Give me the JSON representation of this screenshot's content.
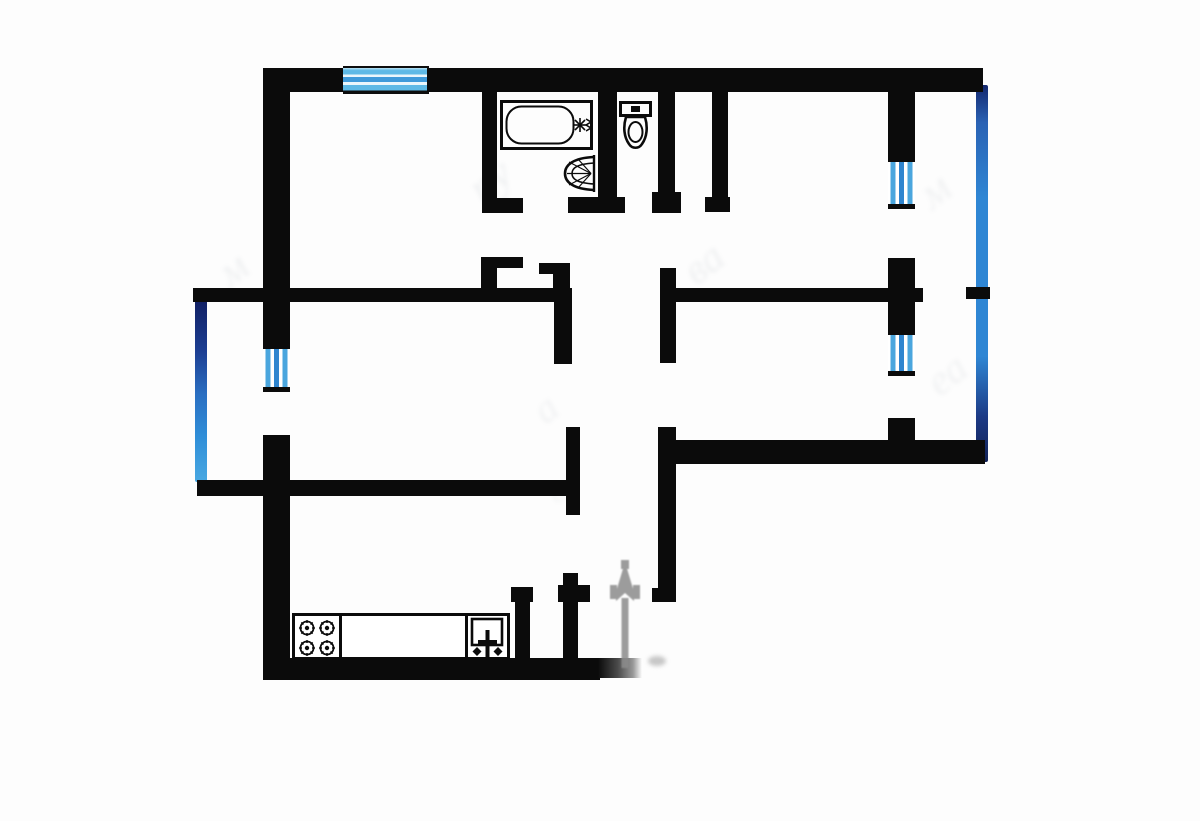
{
  "meta": {
    "title": "apartment-floor-plan",
    "width": 1200,
    "height": 821
  },
  "colors": {
    "wall": "#0b0b0b",
    "window_blue_light": "#5eb9e6",
    "window_blue_mid": "#2f85cf",
    "glazing_navy": "#13276e",
    "glazing_blue": "#2f86d4",
    "arrow_grey": "#8c8c8c",
    "background": "#fdfdfd"
  },
  "plan": {
    "items": [
      {
        "name": "watermark-letter",
        "type": "watermark",
        "x": 470,
        "y": 138,
        "w": 90,
        "h": 70,
        "ch": "пу",
        "size": 44,
        "rot": -38,
        "op": 0.1
      },
      {
        "name": "watermark-letter",
        "type": "watermark",
        "x": 688,
        "y": 228,
        "w": 70,
        "h": 70,
        "ch": "ва",
        "size": 42,
        "rot": -38,
        "op": 0.1
      },
      {
        "name": "watermark-letter",
        "type": "watermark",
        "x": 922,
        "y": 150,
        "w": 70,
        "h": 70,
        "ch": "м",
        "size": 44,
        "rot": -38,
        "op": 0.09
      },
      {
        "name": "watermark-letter",
        "type": "watermark",
        "x": 534,
        "y": 368,
        "w": 70,
        "h": 60,
        "ch": "а",
        "size": 40,
        "rot": -38,
        "op": 0.09
      },
      {
        "name": "watermark-letter",
        "type": "watermark",
        "x": 930,
        "y": 336,
        "w": 80,
        "h": 70,
        "ch": "еа",
        "size": 42,
        "rot": -38,
        "op": 0.09
      },
      {
        "name": "watermark-letter",
        "type": "watermark",
        "x": 222,
        "y": 230,
        "w": 70,
        "h": 70,
        "ch": "м",
        "size": 42,
        "rot": -38,
        "op": 0.1
      },
      {
        "name": "watermark-letter",
        "type": "watermark",
        "x": 548,
        "y": 458,
        "w": 60,
        "h": 50,
        "ch": "в",
        "size": 34,
        "rot": -38,
        "op": 0.07
      },
      {
        "name": "left-balcony-glazing",
        "type": "glazing-l",
        "x": 195,
        "y": 300,
        "w": 12,
        "h": 182
      },
      {
        "name": "right-balcony-glazing",
        "type": "glazing-r",
        "x": 976,
        "y": 85,
        "w": 12,
        "h": 377
      },
      {
        "name": "top-wall-left-segment",
        "type": "wall",
        "x": 263,
        "y": 68,
        "w": 82,
        "h": 24
      },
      {
        "name": "top-wall-window",
        "type": "window-h",
        "x": 343,
        "y": 66,
        "w": 86,
        "h": 28
      },
      {
        "name": "top-wall-right-segment",
        "type": "wall",
        "x": 427,
        "y": 68,
        "w": 556,
        "h": 24
      },
      {
        "name": "left-exterior-wall-upper",
        "type": "wall",
        "x": 263,
        "y": 68,
        "w": 27,
        "h": 278
      },
      {
        "name": "left-balcony-window",
        "type": "window-v",
        "x": 263,
        "y": 344,
        "w": 27,
        "h": 48
      },
      {
        "name": "left-exterior-wall-lower",
        "type": "wall",
        "x": 263,
        "y": 435,
        "w": 27,
        "h": 245
      },
      {
        "name": "kitchen-bottom-wall",
        "type": "wall",
        "x": 263,
        "y": 658,
        "w": 337,
        "h": 22
      },
      {
        "name": "kitchen-bottom-wall-fade",
        "type": "fade-wall",
        "x": 598,
        "y": 658,
        "w": 44,
        "h": 20
      },
      {
        "name": "upper-left-room-bottom-wall",
        "type": "wall",
        "x": 193,
        "y": 288,
        "w": 377,
        "h": 14
      },
      {
        "name": "corridor-left-wall-top",
        "type": "wall",
        "x": 554,
        "y": 288,
        "w": 18,
        "h": 76
      },
      {
        "name": "kitchen-top-wall",
        "type": "wall",
        "x": 197,
        "y": 480,
        "w": 383,
        "h": 16
      },
      {
        "name": "corridor-left-wall-mid",
        "type": "wall",
        "x": 566,
        "y": 427,
        "w": 14,
        "h": 88
      },
      {
        "name": "corridor-left-wall-bottom",
        "type": "wall",
        "x": 563,
        "y": 573,
        "w": 15,
        "h": 89
      },
      {
        "name": "corridor-left-wall-bottom-flare",
        "type": "wall",
        "x": 558,
        "y": 585,
        "w": 32,
        "h": 17
      },
      {
        "name": "larder-jamb",
        "type": "wall",
        "x": 515,
        "y": 587,
        "w": 15,
        "h": 73
      },
      {
        "name": "larder-jamb-flare",
        "type": "wall",
        "x": 511,
        "y": 587,
        "w": 22,
        "h": 15
      },
      {
        "name": "bathroom-left-wall",
        "type": "wall",
        "x": 482,
        "y": 92,
        "w": 15,
        "h": 106
      },
      {
        "name": "bathroom-left-door-foot",
        "type": "wall",
        "x": 482,
        "y": 198,
        "w": 41,
        "h": 15
      },
      {
        "name": "room-door-jamb-left-stub",
        "type": "wall",
        "x": 481,
        "y": 257,
        "w": 16,
        "h": 31
      },
      {
        "name": "room-door-jamb-left-arm",
        "type": "wall",
        "x": 497,
        "y": 257,
        "w": 26,
        "h": 11
      },
      {
        "name": "room-door-jamb-right-stub",
        "type": "wall",
        "x": 553,
        "y": 263,
        "w": 17,
        "h": 25
      },
      {
        "name": "room-door-jamb-right-arm",
        "type": "wall",
        "x": 539,
        "y": 263,
        "w": 14,
        "h": 11
      },
      {
        "name": "bathroom-right-wall",
        "type": "wall",
        "x": 598,
        "y": 85,
        "w": 19,
        "h": 112
      },
      {
        "name": "bathroom-right-door-foot",
        "type": "wall",
        "x": 568,
        "y": 197,
        "w": 57,
        "h": 16
      },
      {
        "name": "toilet-right-wall",
        "type": "wall",
        "x": 658,
        "y": 85,
        "w": 17,
        "h": 107
      },
      {
        "name": "toilet-right-door-foot",
        "type": "wall",
        "x": 652,
        "y": 192,
        "w": 29,
        "h": 21
      },
      {
        "name": "closet-right-wall",
        "type": "wall",
        "x": 712,
        "y": 92,
        "w": 16,
        "h": 105
      },
      {
        "name": "closet-right-door-foot",
        "type": "wall",
        "x": 705,
        "y": 197,
        "w": 25,
        "h": 15
      },
      {
        "name": "corridor-right-wall-top",
        "type": "wall",
        "x": 660,
        "y": 268,
        "w": 16,
        "h": 95
      },
      {
        "name": "right-rooms-divider-wall",
        "type": "wall",
        "x": 676,
        "y": 288,
        "w": 247,
        "h": 14
      },
      {
        "name": "corridor-right-wall-bottom",
        "type": "wall",
        "x": 658,
        "y": 427,
        "w": 18,
        "h": 175
      },
      {
        "name": "corridor-right-wall-foot",
        "type": "wall",
        "x": 652,
        "y": 588,
        "w": 24,
        "h": 14
      },
      {
        "name": "right-room-bottom-wall",
        "type": "wall",
        "x": 658,
        "y": 440,
        "w": 327,
        "h": 24
      },
      {
        "name": "right-balcony-wall-stub",
        "type": "wall",
        "x": 888,
        "y": 418,
        "w": 27,
        "h": 26
      },
      {
        "name": "right-balcony-wall-top",
        "type": "wall",
        "x": 888,
        "y": 83,
        "w": 27,
        "h": 77
      },
      {
        "name": "right-balcony-window-1",
        "type": "window-v",
        "x": 888,
        "y": 157,
        "w": 27,
        "h": 52
      },
      {
        "name": "right-balcony-wall-mid",
        "type": "wall",
        "x": 888,
        "y": 258,
        "w": 27,
        "h": 75
      },
      {
        "name": "right-balcony-window-2",
        "type": "window-v",
        "x": 888,
        "y": 330,
        "w": 27,
        "h": 46
      },
      {
        "name": "right-glazing-tick",
        "type": "wall",
        "x": 966,
        "y": 287,
        "w": 24,
        "h": 12
      },
      {
        "name": "kitchen-counter",
        "type": "box",
        "x": 292,
        "y": 613,
        "w": 218,
        "h": 47
      },
      {
        "name": "counter-divider-stove",
        "type": "vline",
        "x": 339,
        "y": 616,
        "w": 3,
        "h": 44
      },
      {
        "name": "counter-divider-sink",
        "type": "vline",
        "x": 465,
        "y": 616,
        "w": 3,
        "h": 44
      },
      {
        "name": "bathtub",
        "type": "svg-bathtub",
        "x": 500,
        "y": 100,
        "w": 93,
        "h": 50
      },
      {
        "name": "bathroom-sink",
        "type": "svg-bathsink",
        "x": 560,
        "y": 153,
        "w": 37,
        "h": 41
      },
      {
        "name": "toilet",
        "type": "svg-toilet",
        "x": 619,
        "y": 101,
        "w": 33,
        "h": 53
      },
      {
        "name": "stove-burners",
        "type": "svg-burners",
        "x": 295,
        "y": 616,
        "w": 44,
        "h": 44
      },
      {
        "name": "kitchen-sink",
        "type": "svg-ksink",
        "x": 470,
        "y": 617,
        "w": 34,
        "h": 43
      },
      {
        "name": "entry-arrow",
        "type": "svg-arrow",
        "x": 604,
        "y": 558,
        "w": 42,
        "h": 114
      },
      {
        "name": "entry-smudge",
        "type": "blob",
        "x": 648,
        "y": 656,
        "w": 18,
        "h": 10
      }
    ]
  }
}
